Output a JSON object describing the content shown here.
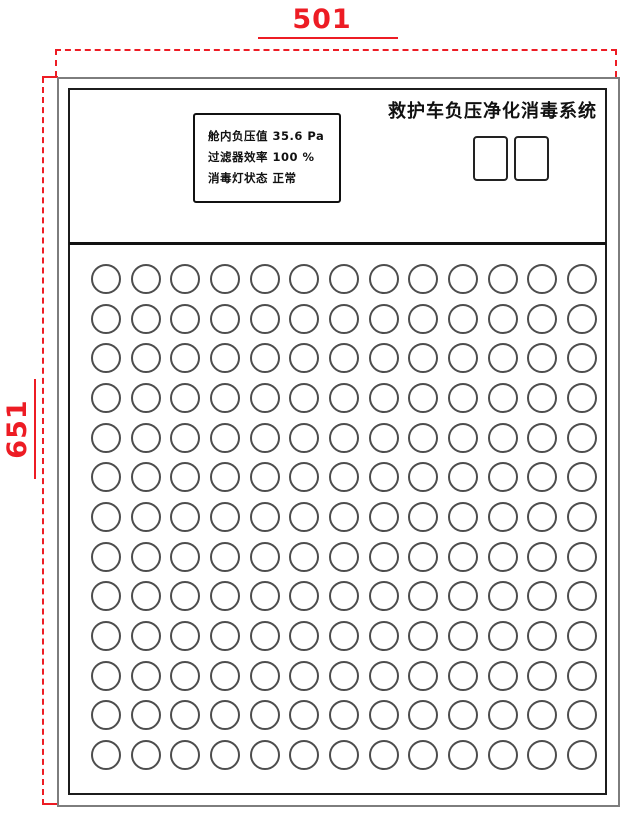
{
  "dimensions": {
    "width_label": "501",
    "height_label": "651",
    "annotation_color": "#ed1c24"
  },
  "panel": {
    "title": "救护车负压净化消毒系统",
    "display": {
      "lines": [
        {
          "label": "舱内负压值",
          "value": "35.6 Pa"
        },
        {
          "label": "过滤器效率",
          "value": "100 %"
        },
        {
          "label": "消毒灯状态",
          "value": "正常"
        }
      ]
    },
    "indicator_buttons": {
      "count": 2
    },
    "hole_grid": {
      "rows": 13,
      "cols": 13
    }
  }
}
